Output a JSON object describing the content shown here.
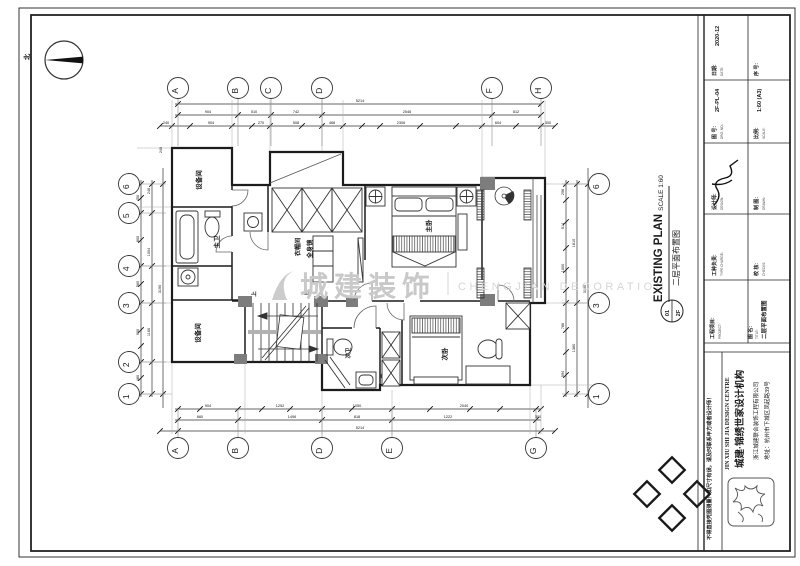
{
  "sheet": {
    "bg": "#ffffff",
    "ink": "#1c1c1c",
    "gray": "#8a8a8a",
    "light": "#c9c9c9"
  },
  "north": {
    "label": "北"
  },
  "watermark": {
    "cn": "城建装饰",
    "en": "CHENGJIAN DECORATION",
    "cn_color": "#c9c9c9",
    "en_color": "#d6d6d6"
  },
  "plan_title": {
    "num": "01",
    "floor": "2F",
    "cn": "二层平面布置图",
    "en": "EXISTING PLAN",
    "scale": "SCALE 1:60"
  },
  "titleblock": {
    "date_label": "日期:",
    "date_sub": "DATE:",
    "date_value": "2020-12",
    "serial_label": "序 号:",
    "dwgno_label": "图 号:",
    "dwgno_sub": "DRG. NO.:",
    "dwgno_value": "2F-PL-04",
    "scale_label": "比例:",
    "scale_sub": "SCALE:",
    "scale_value": "1:60 (A3)",
    "designer_label": "设计师:",
    "designer_sub": "DESIGN:",
    "drawn_label": "制 图:",
    "drawn_sub": "DRAWN:",
    "charge_label": "工种负责:",
    "charge_sub": "TYPE CHARGE:",
    "check_label": "校 核:",
    "check_sub": "CHECKS:",
    "project_label": "工程项目:",
    "project_sub": "PROJECT:",
    "title_label": "图 名:",
    "title_sub": "TITLE:",
    "title_value": "二层平面布置图",
    "disclaimer": "不得直接凭图测量！如尺寸有误，请及时联系甲方或者设计师！",
    "company_en": "JIN XIU SHI JIA DESIGN CENTRE",
    "company_cn": "城建·锦绣世家设计机构",
    "company_sub": "浙江城建联合装饰工程有限公司",
    "company_addr": "地址：杭州市下城区凤起路39号"
  },
  "rooms": [
    {
      "n": "room-label-equipment-1",
      "t": "设备间",
      "x": 201,
      "y": 180,
      "s": 6.5
    },
    {
      "n": "room-label-master-bath",
      "t": "主卫",
      "x": 219,
      "y": 242,
      "s": 6.5
    },
    {
      "n": "room-label-cloakroom",
      "t": "衣帽间",
      "x": 300,
      "y": 247,
      "s": 6.2
    },
    {
      "n": "room-label-mirror",
      "t": "全身镜",
      "x": 312,
      "y": 249,
      "s": 6.2
    },
    {
      "n": "room-label-master-bedroom",
      "t": "主卧",
      "x": 431,
      "y": 226,
      "s": 6.5
    },
    {
      "n": "room-label-equipment-2",
      "t": "设备间",
      "x": 200,
      "y": 333,
      "s": 6.5
    },
    {
      "n": "stair-label-up-1",
      "t": "上",
      "x": 256,
      "y": 294,
      "s": 5.5
    },
    {
      "n": "stair-label-up-2",
      "t": "上",
      "x": 309,
      "y": 294,
      "s": 5.5
    },
    {
      "n": "room-label-second-bath",
      "t": "次卫",
      "x": 350,
      "y": 353,
      "s": 5.5
    },
    {
      "n": "room-label-second-bedroom",
      "t": "次卧",
      "x": 447,
      "y": 354,
      "s": 6.5
    }
  ],
  "grid": {
    "top": [
      {
        "l": "A",
        "x": 178
      },
      {
        "l": "B",
        "x": 238
      },
      {
        "l": "C",
        "x": 271
      },
      {
        "l": "D",
        "x": 322
      },
      {
        "l": "F",
        "x": 492
      },
      {
        "l": "H",
        "x": 541
      }
    ],
    "bottom": [
      {
        "l": "A",
        "x": 178
      },
      {
        "l": "B",
        "x": 238
      },
      {
        "l": "D",
        "x": 322
      },
      {
        "l": "E",
        "x": 392
      },
      {
        "l": "G",
        "x": 536
      }
    ],
    "left": [
      {
        "l": "6",
        "y": 184
      },
      {
        "l": "5",
        "y": 213
      },
      {
        "l": "4",
        "y": 266
      },
      {
        "l": "3",
        "y": 303
      },
      {
        "l": "2",
        "y": 362
      },
      {
        "l": "1",
        "y": 394
      }
    ],
    "right": [
      {
        "l": "6",
        "y": 184
      },
      {
        "l": "3",
        "y": 303
      },
      {
        "l": "1",
        "y": 394
      }
    ]
  },
  "dims": [
    {
      "t": "5214",
      "x": 360,
      "y": 102
    },
    {
      "t": "904",
      "x": 208,
      "y": 113
    },
    {
      "t": "510",
      "x": 254,
      "y": 113
    },
    {
      "t": "742",
      "x": 296,
      "y": 113
    },
    {
      "t": "2546",
      "x": 407,
      "y": 113
    },
    {
      "t": "812",
      "x": 516,
      "y": 113
    },
    {
      "t": "240",
      "x": 166,
      "y": 124
    },
    {
      "t": "904",
      "x": 211,
      "y": 124
    },
    {
      "t": "270",
      "x": 261,
      "y": 124
    },
    {
      "t": "508",
      "x": 296,
      "y": 124
    },
    {
      "t": "468",
      "x": 332,
      "y": 124
    },
    {
      "t": "2306",
      "x": 401,
      "y": 124
    },
    {
      "t": "604",
      "x": 498,
      "y": 124
    },
    {
      "t": "300",
      "x": 548,
      "y": 124
    },
    {
      "t": "904",
      "x": 208,
      "y": 407
    },
    {
      "t": "1252",
      "x": 280,
      "y": 407
    },
    {
      "t": "1050",
      "x": 357,
      "y": 407
    },
    {
      "t": "2040",
      "x": 464,
      "y": 407
    },
    {
      "t": "660",
      "x": 200,
      "y": 418
    },
    {
      "t": "1496",
      "x": 292,
      "y": 418
    },
    {
      "t": "818",
      "x": 357,
      "y": 418
    },
    {
      "t": "1222",
      "x": 448,
      "y": 418
    },
    {
      "t": "300",
      "x": 538,
      "y": 418
    },
    {
      "t": "5214",
      "x": 360,
      "y": 429
    },
    {
      "t": "240",
      "x": 162,
      "y": 150,
      "r": 1
    },
    {
      "t": "450",
      "x": 139,
      "y": 198,
      "r": 1
    },
    {
      "t": "800",
      "x": 139,
      "y": 239,
      "r": 1
    },
    {
      "t": "560",
      "x": 139,
      "y": 284,
      "r": 1
    },
    {
      "t": "900",
      "x": 139,
      "y": 332,
      "r": 1
    },
    {
      "t": "480",
      "x": 139,
      "y": 378,
      "r": 1
    },
    {
      "t": "246",
      "x": 150,
      "y": 191,
      "r": 1
    },
    {
      "t": "1004",
      "x": 150,
      "y": 252,
      "r": 1
    },
    {
      "t": "1160",
      "x": 150,
      "y": 332,
      "r": 1
    },
    {
      "t": "3190",
      "x": 161,
      "y": 289,
      "r": 1
    },
    {
      "t": "296",
      "x": 564,
      "y": 192,
      "r": 1
    },
    {
      "t": "514",
      "x": 564,
      "y": 226,
      "r": 1
    },
    {
      "t": "1000",
      "x": 564,
      "y": 268,
      "r": 1
    },
    {
      "t": "786",
      "x": 564,
      "y": 326,
      "r": 1
    },
    {
      "t": "594",
      "x": 564,
      "y": 374,
      "r": 1
    },
    {
      "t": "1810",
      "x": 575,
      "y": 243,
      "r": 1
    },
    {
      "t": "1380",
      "x": 575,
      "y": 348,
      "r": 1
    },
    {
      "t": "3190",
      "x": 586,
      "y": 289,
      "r": 1
    }
  ]
}
